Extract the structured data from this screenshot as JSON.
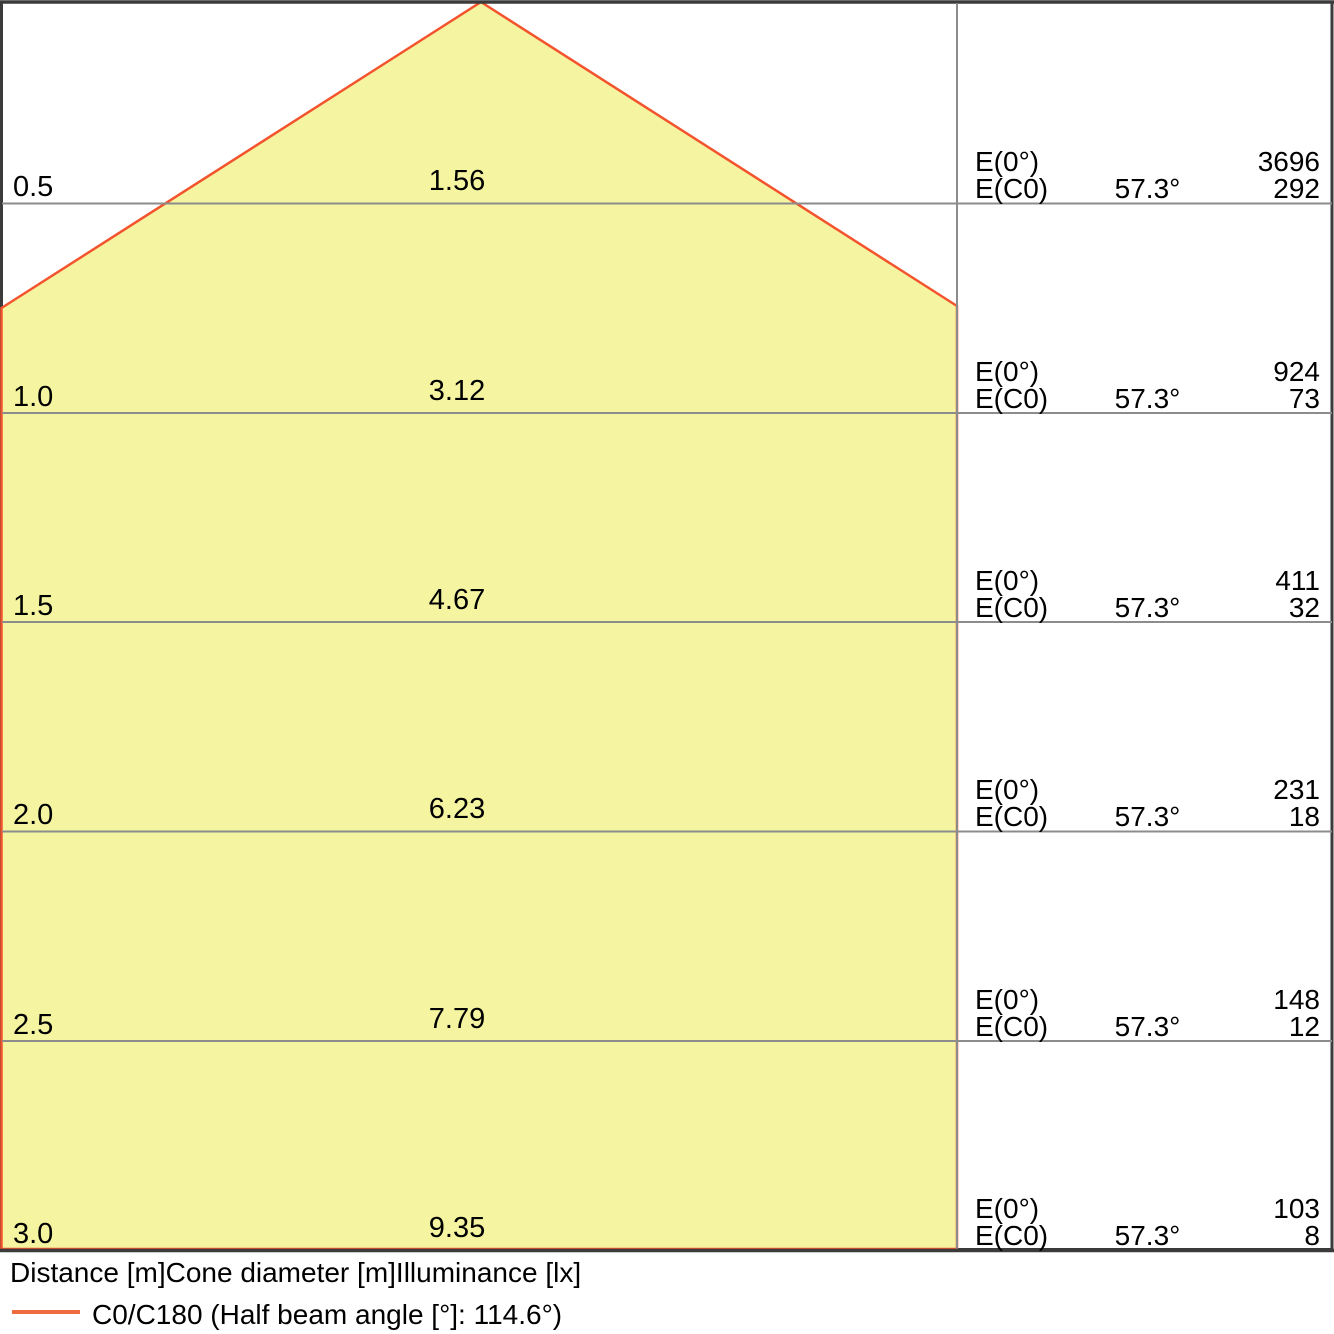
{
  "chart_data": {
    "type": "area",
    "title": "Light cone diagram (illuminance cone)",
    "legend_position": "bottom",
    "axes_caption": "Distance [m]Cone diameter [m]Illuminance [lx]",
    "legend_entry": "C0/C180 (Half beam angle [°]: 114.6°)",
    "half_beam_angle_deg": 114.6,
    "half_angle_column_deg": 57.3,
    "distance_range_m": [
      0,
      3.0
    ],
    "grid": "horizontal lines at each distance step",
    "rows": [
      {
        "distance_m": 0.5,
        "cone_diameter_m": 1.56,
        "E0_lx": 3696,
        "EC0_lx": 292
      },
      {
        "distance_m": 1.0,
        "cone_diameter_m": 3.12,
        "E0_lx": 924,
        "EC0_lx": 73
      },
      {
        "distance_m": 1.5,
        "cone_diameter_m": 4.67,
        "E0_lx": 411,
        "EC0_lx": 32
      },
      {
        "distance_m": 2.0,
        "cone_diameter_m": 6.23,
        "E0_lx": 231,
        "EC0_lx": 18
      },
      {
        "distance_m": 2.5,
        "cone_diameter_m": 7.79,
        "E0_lx": 148,
        "EC0_lx": 12
      },
      {
        "distance_m": 3.0,
        "cone_diameter_m": 9.35,
        "E0_lx": 103,
        "EC0_lx": 8
      }
    ]
  },
  "labels": {
    "e0": "E(0°)",
    "ec0": "E(C0)",
    "angle": "57.3°"
  },
  "rows": [
    {
      "distance": "0.5",
      "diameter": "1.56",
      "e0_value": "3696",
      "ec0_value": "292"
    },
    {
      "distance": "1.0",
      "diameter": "3.12",
      "e0_value": "924",
      "ec0_value": "73"
    },
    {
      "distance": "1.5",
      "diameter": "4.67",
      "e0_value": "411",
      "ec0_value": "32"
    },
    {
      "distance": "2.0",
      "diameter": "6.23",
      "e0_value": "231",
      "ec0_value": "18"
    },
    {
      "distance": "2.5",
      "diameter": "7.79",
      "e0_value": "148",
      "ec0_value": "12"
    },
    {
      "distance": "3.0",
      "diameter": "9.35",
      "e0_value": "103",
      "ec0_value": "8"
    }
  ],
  "footer": {
    "axes_caption": "Distance [m]Cone diameter [m]Illuminance [lx]",
    "legend_label": "C0/C180 (Half beam angle [°]: 114.6°)"
  },
  "colors": {
    "cone_fill": "#F4F4A1",
    "cone_outline": "#F3542E",
    "grid": "#8C8C8C",
    "border": "#3B3B3B",
    "legend_line": "#ED6B3D",
    "background": "#FFFFFF",
    "text": "#000000"
  }
}
